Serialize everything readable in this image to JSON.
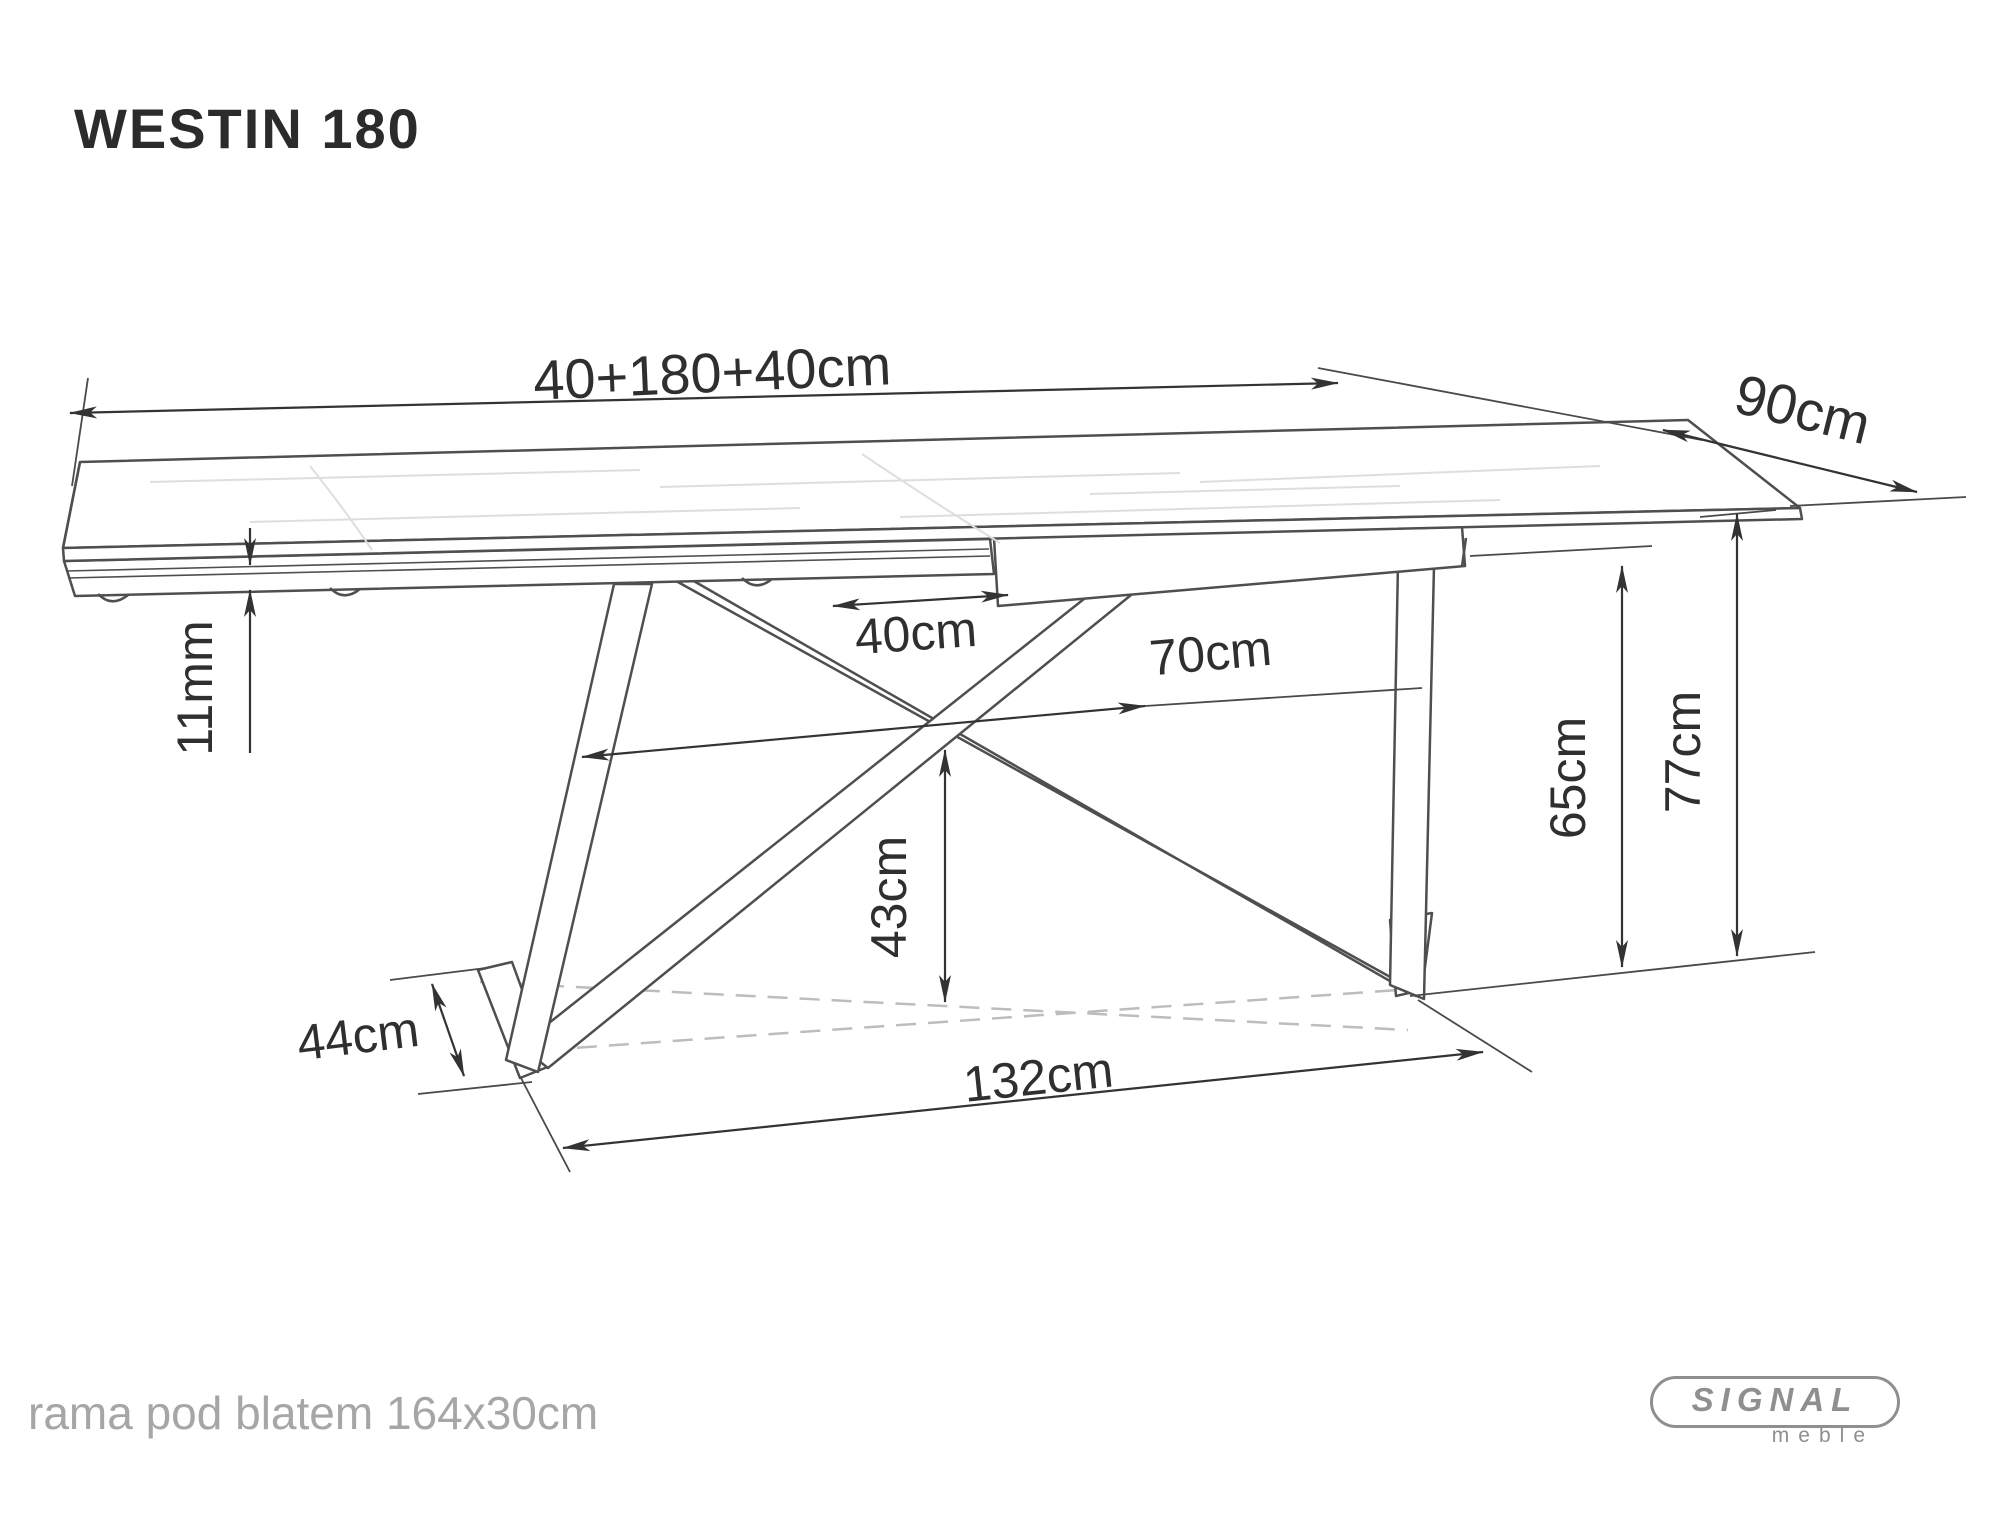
{
  "title": "WESTIN 180",
  "dims": {
    "total_length": "40+180+40cm",
    "depth": "90cm",
    "top_thickness": "11mm",
    "leg_top_gap": "40cm",
    "leg_mid_span": "70cm",
    "center_clearance": "43cm",
    "frame_height": "65cm",
    "table_height": "77cm",
    "foot_depth": "44cm",
    "base_span": "132cm"
  },
  "footer": {
    "note": "rama pod blatem 164x30cm"
  },
  "logo": {
    "brand": "SIGNAL",
    "sub": "meble"
  },
  "colors": {
    "line": "#3a3a3a",
    "muted": "#a6a6a6",
    "dashed": "#bdbdbd"
  }
}
